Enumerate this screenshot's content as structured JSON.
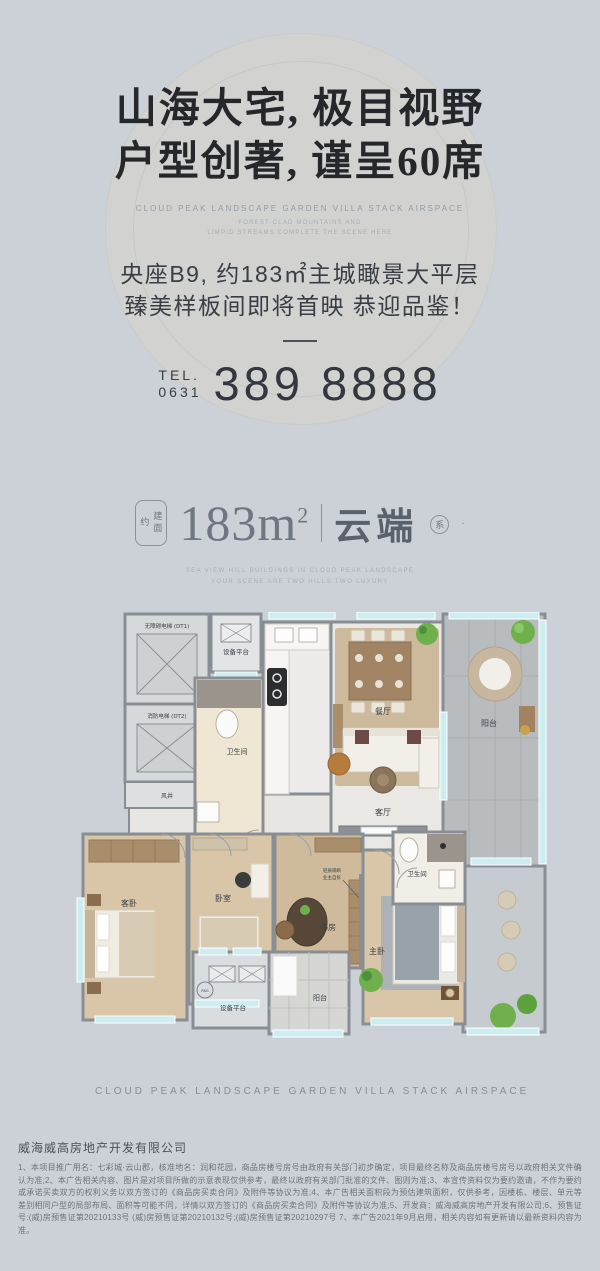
{
  "hero": {
    "headline_line1": "山海大宅, 极目视野",
    "headline_line2": "户型创著, 谨呈60席",
    "subtitle_en": "CLOUD PEAK LANDSCAPE GARDEN VILLA STACK AIRSPACE",
    "subtitle_en_line2": "FOREST-CLAD MOUNTAINS AND",
    "subtitle_en_line3": "LIMPID STREAMS COMPLETE THE SCENE HERE",
    "tagline_line1": "央座B9, 约183㎡主城瞰景大平层",
    "tagline_line2": "臻美样板间即将首映 恭迎品鉴！",
    "tel_label": "TEL.",
    "tel_area_code": "0631",
    "tel_number": "389 8888"
  },
  "area_banner": {
    "prefix_vertical": "建面约",
    "area_value": "183m",
    "area_sup": "2",
    "series_name": "云端",
    "series_badge": "系",
    "series_dot": "·",
    "subtext_line1": "SEA VIEW HILL BUILDINGS IN CLOUD PEAK LANDSCAPE",
    "subtext_line2": "YOUR SCENE ARE TWO HILLS TWO LUXURY"
  },
  "floorplan": {
    "rooms": {
      "equip_top": "设备平台",
      "elevator_dt1": "无障碍电梯 (DT1)",
      "elevator_dt2": "消防电梯 (DT2)",
      "wind_shaft": "风井",
      "bathroom_1": "卫生间",
      "dining": "餐厅",
      "balcony_right": "阳台",
      "living": "客厅",
      "guest_bedroom": "客卧",
      "bedroom": "卧室",
      "study": "书房",
      "bathroom_2": "卫生间",
      "master_bedroom": "主卧",
      "equip_bottom": "设备平台",
      "balcony_bottom": "阳台"
    },
    "annotations": {
      "partition_note_line1": "轻质隔断",
      "partition_note_line2": "业主自拆",
      "rsg": "RSG"
    }
  },
  "footer": {
    "divider_text": "CLOUD PEAK LANDSCAPE GARDEN VILLA STACK AIRSPACE",
    "company": "威海威高房地产开发有限公司",
    "disclaimer": "1、本项目推广用名：七彩城·云山郡，核准地名：润和花园，商品房楼号房号由政府有关部门初步确定，项目最终名称及商品房楼号房号以政府相关文件确认为准;2、本广告相关内容、图片是对项目所做的示意表现仅供参考，最终以政府有关部门批准的文件、图则为准;3、本宣传资料仅为要约邀请，不作为要约或承诺买卖双方的权利义务以双方签订的《商品房买卖合同》及附件等协议为准;4、本广告相关面积段为预估建筑面积，仅供参考，因楼栋、楼层、单元等差别相同户型的局部布局、面积等可能不同，详情以双方签订的《商品房买卖合同》及附件等协议为准;5、开发商：威海威高房地产开发有限公司;6、预售证号:(威)房预售证第20210133号 (威)房预售证第20210132号;(威)房预售证第20210297号 7、本广告2021年9月启用，相关内容如有更新请以最新资料内容为准。"
  },
  "colors": {
    "page_bg": "#ccd1d8",
    "circle_watermark": "#d2d3d0",
    "headline_text": "#26272b",
    "accent_gray_blue": "#6d7681",
    "window_teal": "#cdeef0",
    "wood_floor": "#d9c6a8",
    "wall_gray": "#888e94",
    "plant_green": "#6fb04c"
  }
}
